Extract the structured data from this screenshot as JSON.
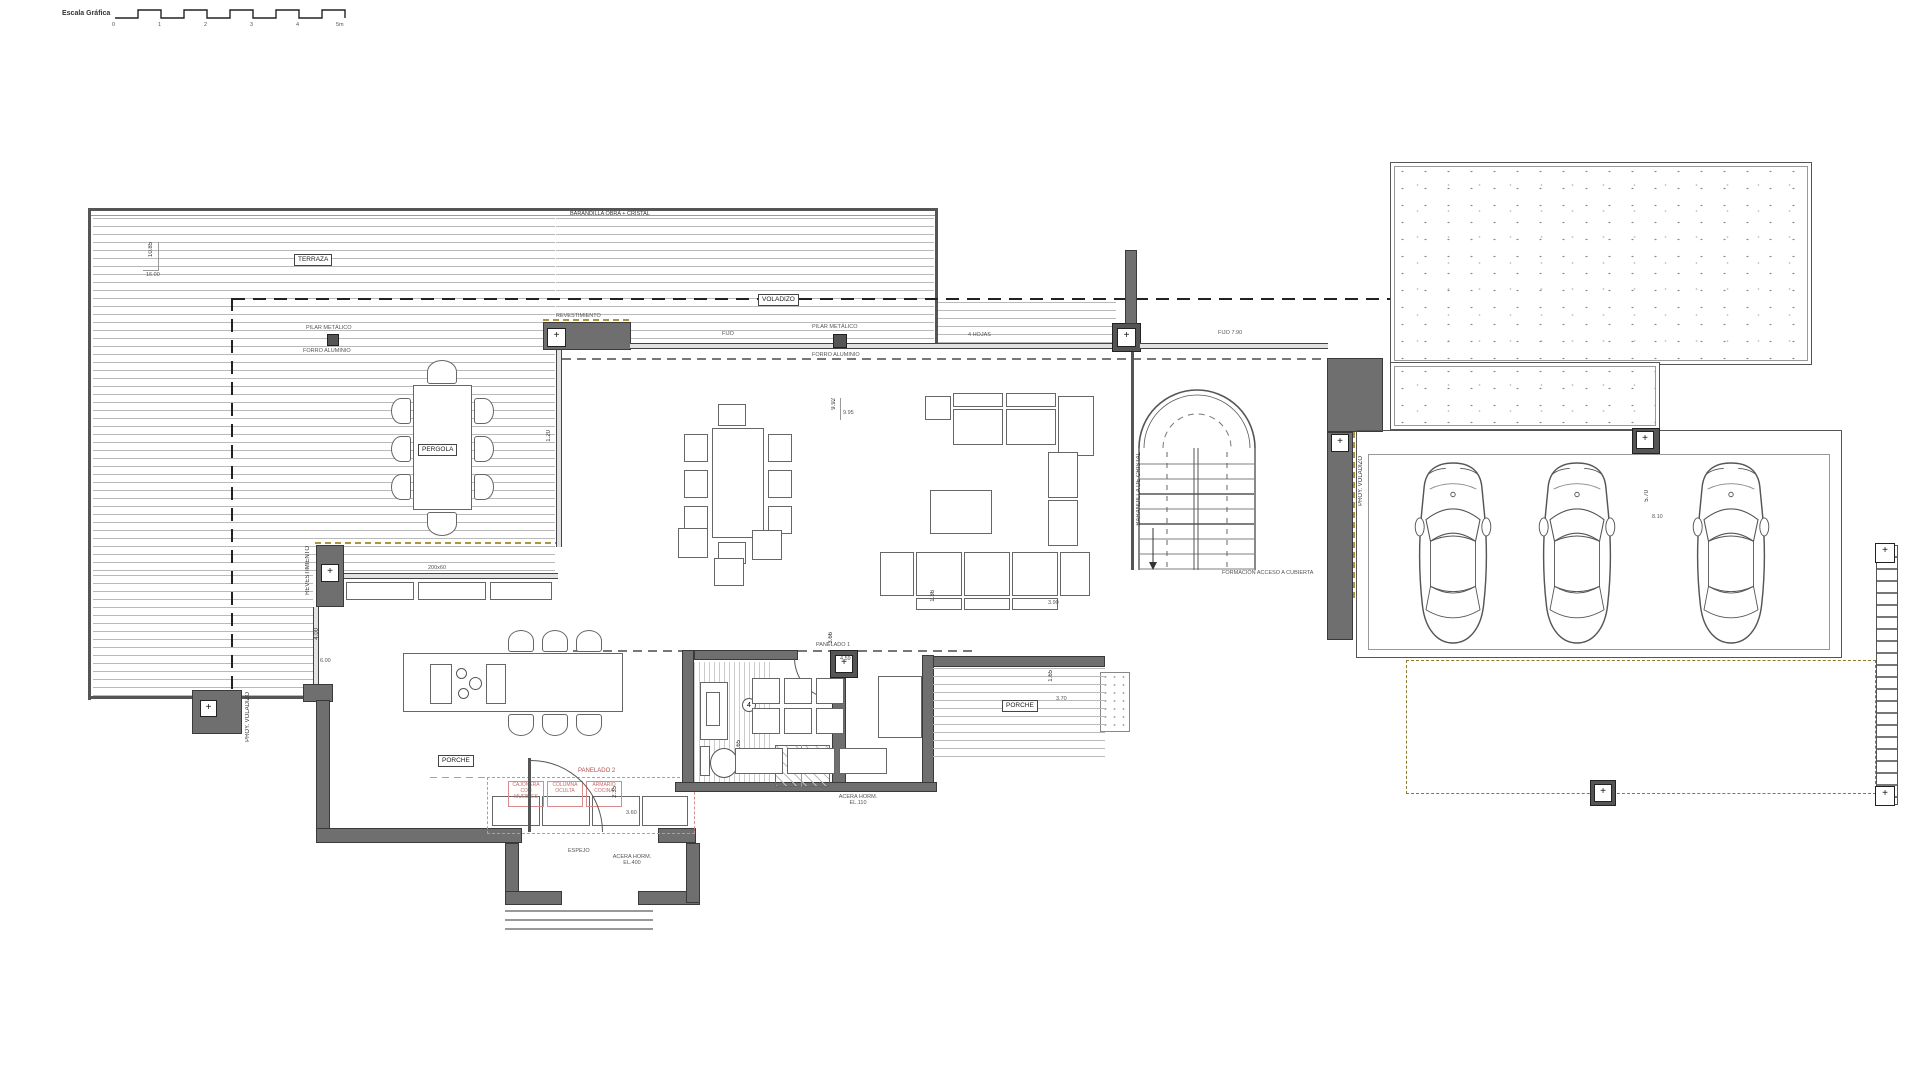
{
  "scale_bar": {
    "label": "Escala Gráfica",
    "ticks": [
      "0",
      "1",
      "2",
      "3",
      "4",
      "5m"
    ]
  },
  "terrace": {
    "railing_label": "BARANDILLA OBRA + CRISTAL",
    "name": "TERRAZA",
    "dim_height": "10.85",
    "dim_width": "16.00",
    "pilar_label": "PILAR METÁLICO",
    "forro_label": "FORRO ALUMINIO",
    "pergola_label": "PERGOLA",
    "proy_voladizo": "PROY. VOLADIZO",
    "voladizo_label": "VOLADIZO"
  },
  "north_wall": {
    "revestimiento": "REVESTIMIENTO",
    "fijo": "FIJO",
    "pilar": "PILAR METÁLICO",
    "forro": "FORRO ALUMINIO",
    "hojas": "4 HOJAS",
    "fijo_right": "FIJO 7.90"
  },
  "great_room": {
    "dim_a": "9.92",
    "dim_b": "9.95",
    "dim_west": "1.20"
  },
  "kitchen": {
    "wall_dim": "200x60",
    "revestimiento": "REVESTIMIENTO",
    "dim_v": "4.00",
    "dim_h": "6.00",
    "panelado": "PANELADO 2",
    "note_1": "CAJONERA CON MUEBLES",
    "note_2": "COLUMNA OCULTA",
    "note_3": "ARMARIO COCINA"
  },
  "bathroom": {
    "number": "4",
    "dim_a": "1.65",
    "dim_b": "1.20",
    "panelado": "PANELADO 1"
  },
  "family_room": {
    "dim_a": "3.66",
    "dim_b": "4.59",
    "dim_c": "1.36",
    "dim_d": "3.90"
  },
  "stairs": {
    "rail_label": "BARANDILLA DE CRISTAL",
    "note": "FORMACIÓN ACCESO A CUBIERTA"
  },
  "garage": {
    "dim_v": "5.70",
    "dim_h": "8.10",
    "proy_voladizo": "PROY. VOLADIZO"
  },
  "entry": {
    "espejo": "ESPEJO",
    "acera": "ACERA HORM. EL.400",
    "dim_a": "3.60",
    "dim_b": "2.35",
    "porche_label": "PORCHE"
  },
  "porch_east": {
    "label": "PORCHE",
    "dim_a": "1.65",
    "dim_b": "3.70",
    "acera": "ACERA HORM. EL.110"
  },
  "colors": {
    "wall": "#6f6f6f",
    "line": "#555555",
    "accent_olive": "#ab9540",
    "accent_red": "#c96a6a"
  }
}
